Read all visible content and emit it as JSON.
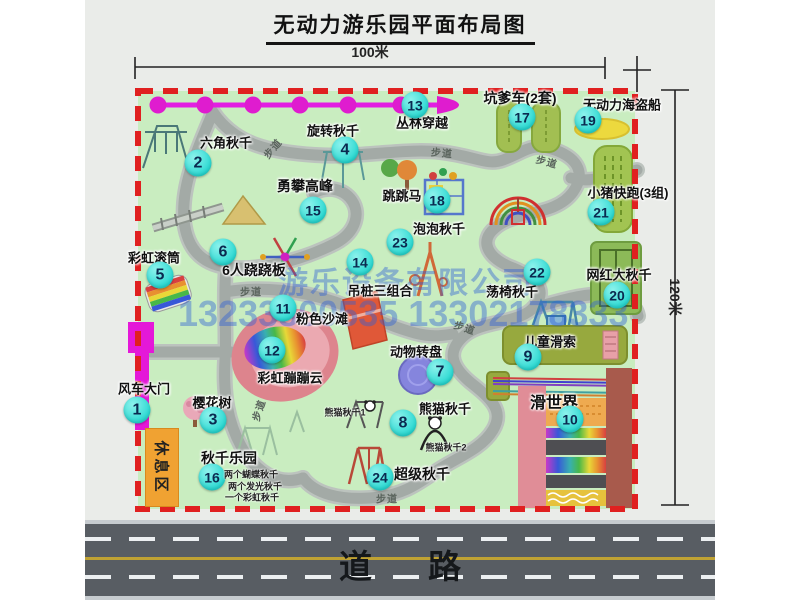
{
  "title": "无动力游乐园平面布局图",
  "dims": {
    "w": "100米",
    "h": "120米"
  },
  "watermark": {
    "company": "游乐设备有限公司",
    "phone": "13233800535 13302178333"
  },
  "road_label": "道路",
  "rest_area_label": "休息区",
  "walkway_label": "步道",
  "walkways": [
    {
      "x": 187,
      "y": 148,
      "r": -50
    },
    {
      "x": 357,
      "y": 152,
      "r": 5
    },
    {
      "x": 462,
      "y": 161,
      "r": 15
    },
    {
      "x": 166,
      "y": 291,
      "r": 0
    },
    {
      "x": 380,
      "y": 327,
      "r": 18
    },
    {
      "x": 173,
      "y": 410,
      "r": -72
    },
    {
      "x": 302,
      "y": 498,
      "r": 0
    }
  ],
  "attractions": [
    {
      "num": "1",
      "name": "风车大门",
      "badge": [
        52,
        410
      ],
      "label": [
        59,
        388
      ]
    },
    {
      "num": "2",
      "name": "六角秋千",
      "badge": [
        113,
        163
      ],
      "label": [
        141,
        142
      ]
    },
    {
      "num": "3",
      "name": "樱花树",
      "badge": [
        128,
        420
      ],
      "label": [
        127,
        402
      ]
    },
    {
      "num": "4",
      "name": "旋转秋千",
      "badge": [
        260,
        150
      ],
      "label": [
        248,
        130
      ]
    },
    {
      "num": "5",
      "name": "彩虹滚筒",
      "badge": [
        75,
        275
      ],
      "label": [
        69,
        257
      ]
    },
    {
      "num": "6",
      "name": "6人跷跷板",
      "badge": [
        138,
        252
      ],
      "label": [
        169,
        270
      ],
      "fs": 14
    },
    {
      "num": "7",
      "name": "动物转盘",
      "badge": [
        355,
        372
      ],
      "label": [
        331,
        351
      ]
    },
    {
      "num": "8",
      "name": "熊猫秋千",
      "badge": [
        318,
        423
      ],
      "label": [
        360,
        408
      ],
      "subs": [
        {
          "text": "熊猫秋千1",
          "x": 260,
          "y": 412
        },
        {
          "text": "熊猫秋千2",
          "x": 361,
          "y": 447
        }
      ]
    },
    {
      "num": "9",
      "name": "儿童滑索",
      "badge": [
        443,
        357
      ],
      "label": [
        465,
        341
      ]
    },
    {
      "num": "10",
      "name": "滑世界",
      "badge": [
        485,
        419
      ],
      "label": [
        469,
        401
      ],
      "fs": 16
    },
    {
      "num": "11",
      "name": "粉色沙滩",
      "badge": [
        198,
        308
      ],
      "label": [
        237,
        318
      ]
    },
    {
      "num": "12",
      "name": "彩虹蹦蹦云",
      "badge": [
        187,
        350
      ],
      "label": [
        205,
        377
      ]
    },
    {
      "num": "13",
      "name": "丛林穿越",
      "badge": [
        330,
        105
      ],
      "label": [
        337,
        122
      ]
    },
    {
      "num": "14",
      "name": "吊桩三组合",
      "badge": [
        275,
        262
      ],
      "label": [
        295,
        290
      ]
    },
    {
      "num": "15",
      "name": "勇攀高峰",
      "badge": [
        228,
        210
      ],
      "label": [
        220,
        186
      ],
      "fs": 14
    },
    {
      "num": "16",
      "name": "秋千乐园",
      "badge": [
        127,
        477
      ],
      "label": [
        144,
        458
      ],
      "fs": 14,
      "subs": [
        {
          "text": "两个蝴蝶秋千",
          "x": 166,
          "y": 474
        },
        {
          "text": "两个发光秋千",
          "x": 170,
          "y": 486
        },
        {
          "text": "一个彩虹秋千",
          "x": 167,
          "y": 497
        }
      ]
    },
    {
      "num": "17",
      "name": "坑爹车(2套)",
      "badge": [
        437,
        117
      ],
      "label": [
        435,
        98
      ],
      "fs": 14
    },
    {
      "num": "18",
      "name": "跳跳马",
      "badge": [
        352,
        200
      ],
      "label": [
        317,
        195
      ]
    },
    {
      "num": "19",
      "name": "无动力海盗船",
      "badge": [
        503,
        120
      ],
      "label": [
        537,
        104
      ]
    },
    {
      "num": "20",
      "name": "网红大秋千",
      "badge": [
        532,
        295
      ],
      "label": [
        534,
        274
      ]
    },
    {
      "num": "21",
      "name": "小猪快跑(3组)",
      "badge": [
        516,
        212
      ],
      "label": [
        543,
        192
      ]
    },
    {
      "num": "22",
      "name": "荡椅秋千",
      "badge": [
        452,
        272
      ],
      "label": [
        427,
        291
      ]
    },
    {
      "num": "23",
      "name": "泡泡秋千",
      "badge": [
        315,
        242
      ],
      "label": [
        354,
        228
      ]
    },
    {
      "num": "24",
      "name": "超级秋千",
      "badge": [
        295,
        477
      ],
      "label": [
        337,
        474
      ],
      "fs": 14
    }
  ],
  "colors": {
    "park_green": "#c9edc0",
    "border_red": "#e02020",
    "path_gray": "#a3aaa6",
    "badge_cyan": "#2bd9d2",
    "chain_magenta": "#df1ccf",
    "road_gray": "#585d63",
    "rest_orange": "#f0a232",
    "watermark_blue": "#2d5fd7"
  }
}
